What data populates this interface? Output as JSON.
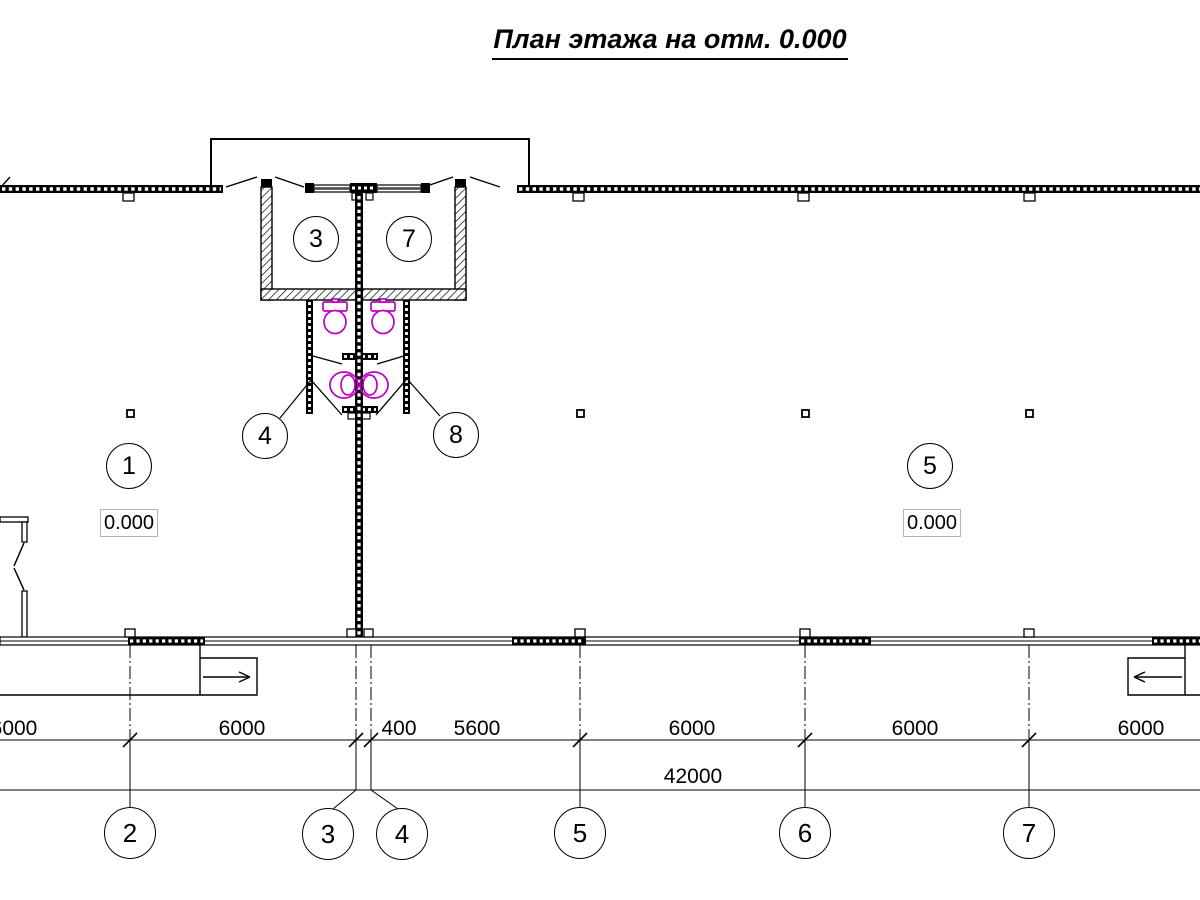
{
  "title": "План этажа на отм. 0.000",
  "rooms": {
    "bubble_1": "1",
    "bubble_3": "3",
    "bubble_7": "7",
    "bubble_5": "5"
  },
  "callouts": {
    "c4": "4",
    "c8": "8"
  },
  "elevations": {
    "left": "0.000",
    "right": "0.000"
  },
  "grid_axes": {
    "a2": "2",
    "a3": "3",
    "a4": "4",
    "a5": "5",
    "a6": "6",
    "a7": "7"
  },
  "dimensions": {
    "d1": "6000",
    "d2": "6000",
    "d3": "400",
    "d4": "5600",
    "d5": "6000",
    "d6": "6000",
    "d7": "6000",
    "total": "42000"
  },
  "colors": {
    "line": "#000000",
    "plumbing": "#c000c0"
  }
}
